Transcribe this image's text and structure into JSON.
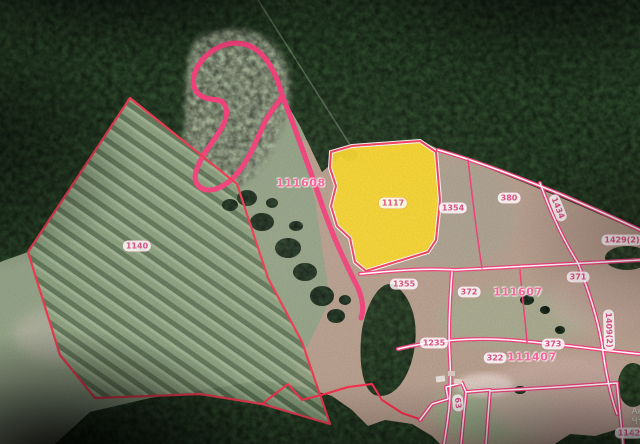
{
  "map": {
    "cadastral_quarter_labels": [
      {
        "text": "111608"
      },
      {
        "text": "111607"
      },
      {
        "text": "111407"
      }
    ],
    "parcel_labels": [
      {
        "text": "1117"
      },
      {
        "text": "1354"
      },
      {
        "text": "380"
      },
      {
        "text": "1429(2)"
      },
      {
        "text": "1434"
      },
      {
        "text": "1140"
      },
      {
        "text": "1355"
      },
      {
        "text": "372"
      },
      {
        "text": "371"
      },
      {
        "text": "1235"
      },
      {
        "text": "322"
      },
      {
        "text": "373"
      },
      {
        "text": "63"
      },
      {
        "text": "1409(2)"
      },
      {
        "text": "1142"
      }
    ],
    "colors": {
      "selected_parcel_fill": "#f8d62e",
      "boundary_pink": "#f2427c",
      "boundary_red": "#ef3a52",
      "quarter_label_pink": "#ff5c9a",
      "pill_text_pink": "#d94f82"
    }
  },
  "watermark": {
    "line1": "Актива",
    "line2": "Чтобы акти",
    "line3": "Пара"
  }
}
